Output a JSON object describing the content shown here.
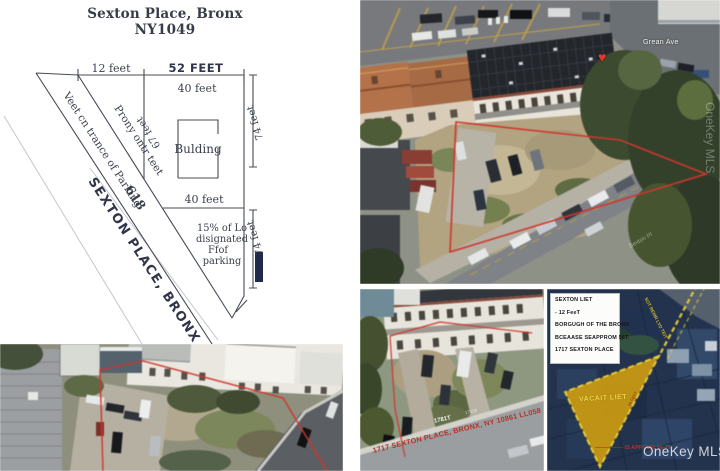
{
  "diagram": {
    "title_line1": "Sexton Place, Bronx",
    "title_line2": "NY1049",
    "dim_left_top": "12 feet",
    "dim_right_top": "52 FEET",
    "dim_building_top": "40 feet",
    "dim_building_bottom": "40 feet",
    "dim_side_upper": "74 feet",
    "dim_side_lower": "74 feet",
    "dim_inner": "67 feet",
    "building_label": "Bulding",
    "street_name": "SEXTON PLACE, BRONX 10469",
    "lot_number": "618",
    "note_entrance": "Veet cn trance of Parking",
    "note_frontage": "Prony ontr teet",
    "parking_note": [
      "15% of Lo",
      "disignated",
      "Ffof",
      "parking"
    ]
  },
  "aerial_main": {
    "street_label": "Grean Ave",
    "road_name": "Sexton Pl",
    "marker_icon": "heart",
    "marker_glyph": "♥"
  },
  "aerial_side": {
    "curb_text": "1717 SEXTON PLACE, BRONX, NY 10861 LL058",
    "curb_text_alt": "1781T",
    "curb_text_faint": "17118"
  },
  "map_inset": {
    "info_lines": [
      "SEXTON LIET",
      "- 12 FeeT",
      "BORGUGH OF THE BRONX",
      "BCEAASE SEAPPROM 56T.",
      "1717 SEXTON PLACE"
    ],
    "lot_label": "VACAIT LIET",
    "road_label": "SOT REMR LYD TEIT",
    "edge_label": "56 FEET",
    "red_note": "————— IS APPOUR 56-7T",
    "lot_fill": "#c9990e",
    "lot_border": "#ecd23a"
  },
  "watermark": {
    "text": "OneKey MLS"
  },
  "colors": {
    "red_outline": "#d5342a",
    "navy_bar": "#222a4c"
  }
}
